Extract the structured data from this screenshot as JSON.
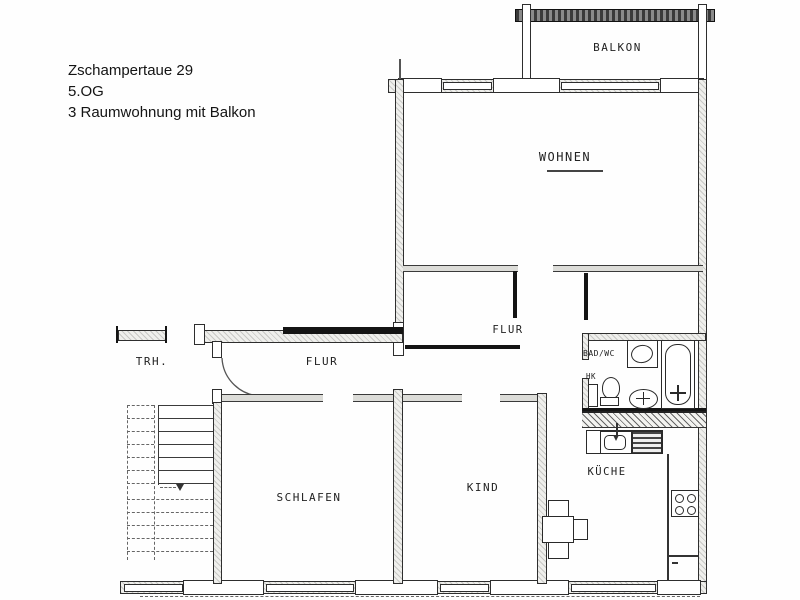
{
  "header": {
    "address": "Zschampertaue 29",
    "floor": "5.OG",
    "description": "3 Raumwohnung mit Balkon"
  },
  "rooms": {
    "balkon": "BALKON",
    "wohnen": "WOHNEN",
    "flur_upper": "FLUR",
    "flur_lower": "FLUR",
    "trh": "TRH.",
    "schlafen": "SCHLAFEN",
    "kind": "KIND",
    "kueche": "KÜCHE",
    "bad_wc": "BAD/WC",
    "heizkoerper": "HK"
  },
  "colors": {
    "line": "#2e2e2e",
    "paper": "#ffffff",
    "text": "#222222"
  }
}
